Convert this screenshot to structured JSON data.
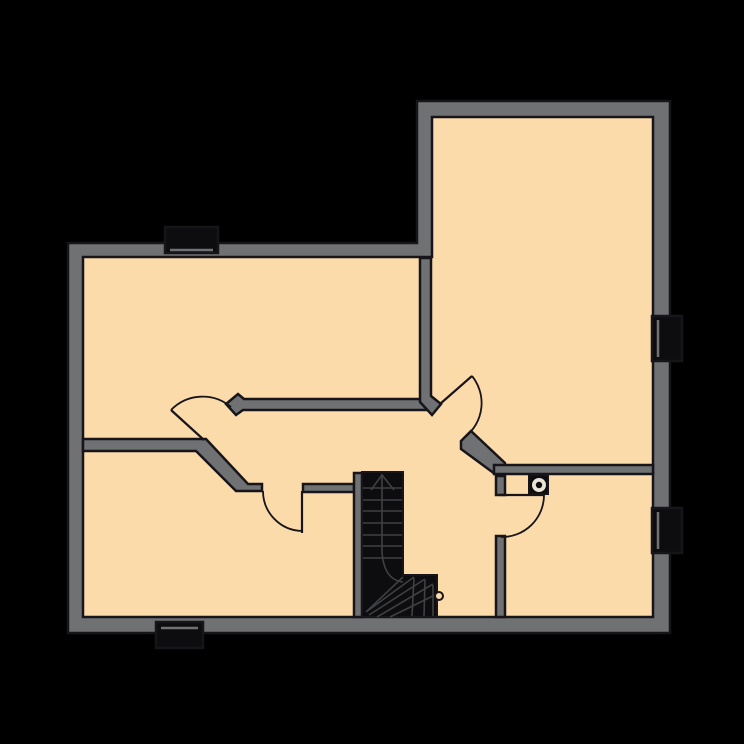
{
  "canvas": {
    "width": 744,
    "height": 744
  },
  "palette": {
    "bg": "#000000",
    "wall": "#6f7173",
    "ink": "#17141a",
    "floor": "#fcdbab",
    "dark": "#0d0d0f",
    "tread": "#3f4044",
    "light": "#eae4d6"
  },
  "floorplan": {
    "shapes": [
      {
        "name": "floor-area",
        "type": "polygon",
        "points": "83,257 432,257 432,117 653,117 653,617 83,617",
        "fill": "floor"
      },
      {
        "name": "outer-walls",
        "type": "path",
        "d": "M68,243 L417,243 L417,101 L670,101 L670,633 L68,633 Z M83,257 L432,257 L432,117 L653,117 L653,617 L83,617 Z",
        "fill": "wall",
        "stroke": "ink",
        "sw": 2.5,
        "evenodd": true
      },
      {
        "name": "window-top-box",
        "type": "rect",
        "x": 165,
        "y": 227,
        "w": 53,
        "h": 26,
        "fill": "dark",
        "stroke": "ink",
        "sw": 2.5
      },
      {
        "name": "window-top-frame-line",
        "type": "line",
        "x1": 170,
        "y1": 250,
        "x2": 213,
        "y2": 250,
        "stroke": "wall",
        "sw": 2.5
      },
      {
        "name": "window-bottom-box",
        "type": "rect",
        "x": 156,
        "y": 622,
        "w": 47,
        "h": 26,
        "fill": "dark",
        "stroke": "ink",
        "sw": 2.5
      },
      {
        "name": "window-bottom-frame-line",
        "type": "line",
        "x1": 161,
        "y1": 628,
        "x2": 198,
        "y2": 628,
        "stroke": "wall",
        "sw": 2.5
      },
      {
        "name": "window-right-upper-box",
        "type": "rect",
        "x": 652,
        "y": 316,
        "w": 30,
        "h": 45,
        "fill": "dark",
        "stroke": "ink",
        "sw": 2.5
      },
      {
        "name": "window-right-upper-frame-line",
        "type": "line",
        "x1": 658,
        "y1": 320,
        "x2": 658,
        "y2": 357,
        "stroke": "wall",
        "sw": 2.5
      },
      {
        "name": "window-right-lower-box",
        "type": "rect",
        "x": 652,
        "y": 508,
        "w": 30,
        "h": 45,
        "fill": "dark",
        "stroke": "ink",
        "sw": 2.5
      },
      {
        "name": "window-right-lower-frame-line",
        "type": "line",
        "x1": 658,
        "y1": 512,
        "x2": 658,
        "y2": 549,
        "stroke": "wall",
        "sw": 2.5
      },
      {
        "name": "wall-left-divider",
        "type": "polygon",
        "points": "83,439 206,439 248,484 262,484 262,491 236,491 196,451 83,451",
        "fill": "wall",
        "stroke": "ink",
        "sw": 2.5
      },
      {
        "name": "wall-hall-bottom",
        "type": "rect",
        "x": 303,
        "y": 484,
        "w": 51,
        "h": 8,
        "fill": "wall",
        "stroke": "ink",
        "sw": 2.5
      },
      {
        "name": "wall-stair-side",
        "type": "rect",
        "x": 354,
        "y": 473,
        "w": 8,
        "h": 144,
        "fill": "wall",
        "stroke": "ink",
        "sw": 2.5
      },
      {
        "name": "wall-hall-top",
        "type": "polygon",
        "points": "244,399 431,399 431,410 243,410 236,415 226,404 238,394",
        "fill": "wall",
        "stroke": "ink",
        "sw": 2.5
      },
      {
        "name": "wall-upper-divider",
        "type": "polygon",
        "points": "420,258 431,258 431,396 441,404 432,415 420,402",
        "fill": "wall",
        "stroke": "ink",
        "sw": 2.5
      },
      {
        "name": "wall-right-diagonal",
        "type": "polygon",
        "points": "461,441 471,431 505,463 505,474 495,474 461,449",
        "fill": "wall",
        "stroke": "ink",
        "sw": 2.5
      },
      {
        "name": "wall-kitchen-top",
        "type": "rect",
        "x": 494,
        "y": 465,
        "w": 159,
        "h": 9,
        "fill": "wall",
        "stroke": "ink",
        "sw": 2.5
      },
      {
        "name": "wall-door-stub",
        "type": "rect",
        "x": 496,
        "y": 476,
        "w": 9,
        "h": 19,
        "fill": "wall",
        "stroke": "ink",
        "sw": 2.5
      },
      {
        "name": "wall-lower-divider",
        "type": "rect",
        "x": 496,
        "y": 536,
        "w": 9,
        "h": 81,
        "fill": "wall",
        "stroke": "ink",
        "sw": 2.5
      },
      {
        "name": "flue-box",
        "type": "rect",
        "x": 529,
        "y": 475,
        "w": 19,
        "h": 19,
        "fill": "dark",
        "stroke": "ink",
        "sw": 2
      },
      {
        "name": "flue-ring",
        "type": "circle",
        "cx": 539,
        "cy": 485,
        "r": 7,
        "fill": "light"
      },
      {
        "name": "flue-dot",
        "type": "circle",
        "cx": 539,
        "cy": 485,
        "r": 3.2,
        "fill": "dark"
      },
      {
        "name": "staircase-body",
        "type": "path",
        "d": "M362,472 L403,472 L403,575 L437,575 L437,617 L362,617 Z",
        "fill": "dark",
        "stroke": "ink",
        "sw": 2
      },
      {
        "name": "staircase-treads",
        "type": "path",
        "d": "M363,488 H402 M363,500 H402 M363,511 H402 M363,523 H402 M363,535 H402 M363,546 H402 M363,558 H402",
        "fill": "none",
        "stroke": "tread",
        "sw": 1.6
      },
      {
        "name": "staircase-centerline",
        "type": "path",
        "d": "M382,474 V552 Q384,580 403,582",
        "fill": "none",
        "stroke": "tread",
        "sw": 1.6
      },
      {
        "name": "staircase-up-arrow",
        "type": "path",
        "d": "M371,490 L382,475 L394,490",
        "fill": "none",
        "stroke": "tread",
        "sw": 1.6
      },
      {
        "name": "staircase-winders",
        "type": "path",
        "d": "M366,612 L403,577 M366,612 L414,577 M369,615 L425,579 M377,617 L433,584 M390,617 L437,594 M414,578 L412,616 M425,580 L424,616 M433,585 L433,616",
        "fill": "none",
        "stroke": "tread",
        "sw": 1.6
      },
      {
        "name": "staircase-knob",
        "type": "circle",
        "cx": 439,
        "cy": 596,
        "r": 4,
        "fill": "floor",
        "stroke": "ink",
        "sw": 2
      },
      {
        "name": "door-hall-left-leaf",
        "type": "path",
        "d": "M204,440 L171,410",
        "fill": "none",
        "stroke": "ink",
        "sw": 2.2
      },
      {
        "name": "door-hall-left-arc",
        "type": "path",
        "d": "M171,410 A44,44 0 0 1 231,407",
        "fill": "none",
        "stroke": "ink",
        "sw": 1.8
      },
      {
        "name": "door-upper-room-leaf",
        "type": "path",
        "d": "M440,404 L472,376",
        "fill": "none",
        "stroke": "ink",
        "sw": 2.2
      },
      {
        "name": "door-upper-room-arc",
        "type": "path",
        "d": "M472,376 A43,43 0 0 1 465,437",
        "fill": "none",
        "stroke": "ink",
        "sw": 1.8
      },
      {
        "name": "door-lower-left-leaf",
        "type": "path",
        "d": "M302,491 L302,533",
        "fill": "none",
        "stroke": "ink",
        "sw": 2.2
      },
      {
        "name": "door-lower-left-arc",
        "type": "path",
        "d": "M263,491 A40,40 0 0 0 302,531",
        "fill": "none",
        "stroke": "ink",
        "sw": 1.8
      },
      {
        "name": "door-lower-right-leaf",
        "type": "path",
        "d": "M500,495 L544,495",
        "fill": "none",
        "stroke": "ink",
        "sw": 2.2
      },
      {
        "name": "door-lower-right-arc",
        "type": "path",
        "d": "M544,495 A42,42 0 0 1 501,537",
        "fill": "none",
        "stroke": "ink",
        "sw": 1.8
      }
    ]
  }
}
